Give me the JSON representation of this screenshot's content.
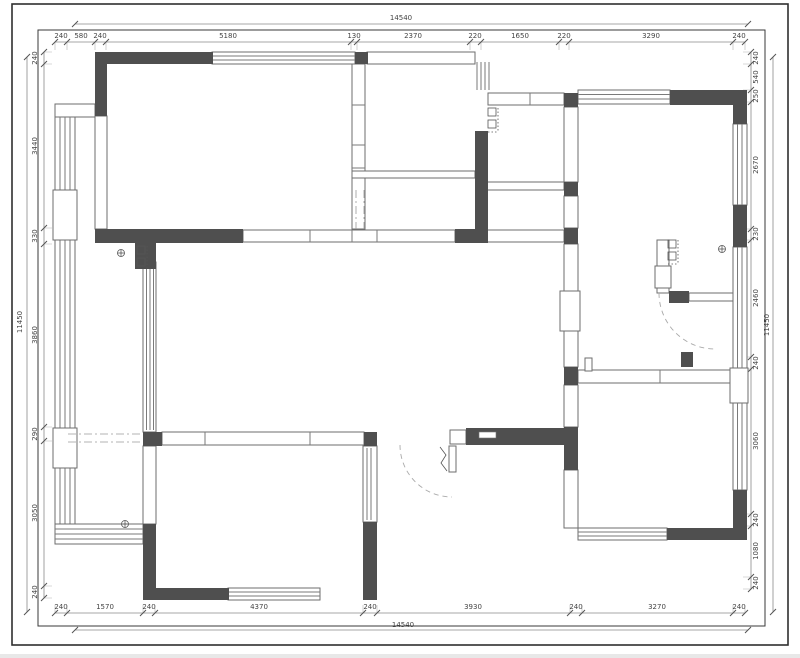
{
  "dims": {
    "top": {
      "total": "14540",
      "segments": [
        "240",
        "580",
        "240",
        "5180",
        "130",
        "2370",
        "220",
        "1650",
        "220",
        "3290",
        "240"
      ]
    },
    "bottom": {
      "total": "14540",
      "segments": [
        "240",
        "1570",
        "240",
        "4370",
        "240",
        "3930",
        "240",
        "3270",
        "240"
      ]
    },
    "left": {
      "total": "11450",
      "segments": [
        "240",
        "3440",
        "330",
        "3860",
        "290",
        "3050",
        "240"
      ]
    },
    "right": {
      "total": "11450",
      "segments": [
        "240",
        "540",
        "250",
        "2670",
        "230",
        "2460",
        "240",
        "3060",
        "240",
        "1080",
        "240"
      ]
    }
  },
  "colors": {
    "wall_fill": "#4f4f4f",
    "border": "#2f2f2f",
    "dim_text": "#444444"
  }
}
